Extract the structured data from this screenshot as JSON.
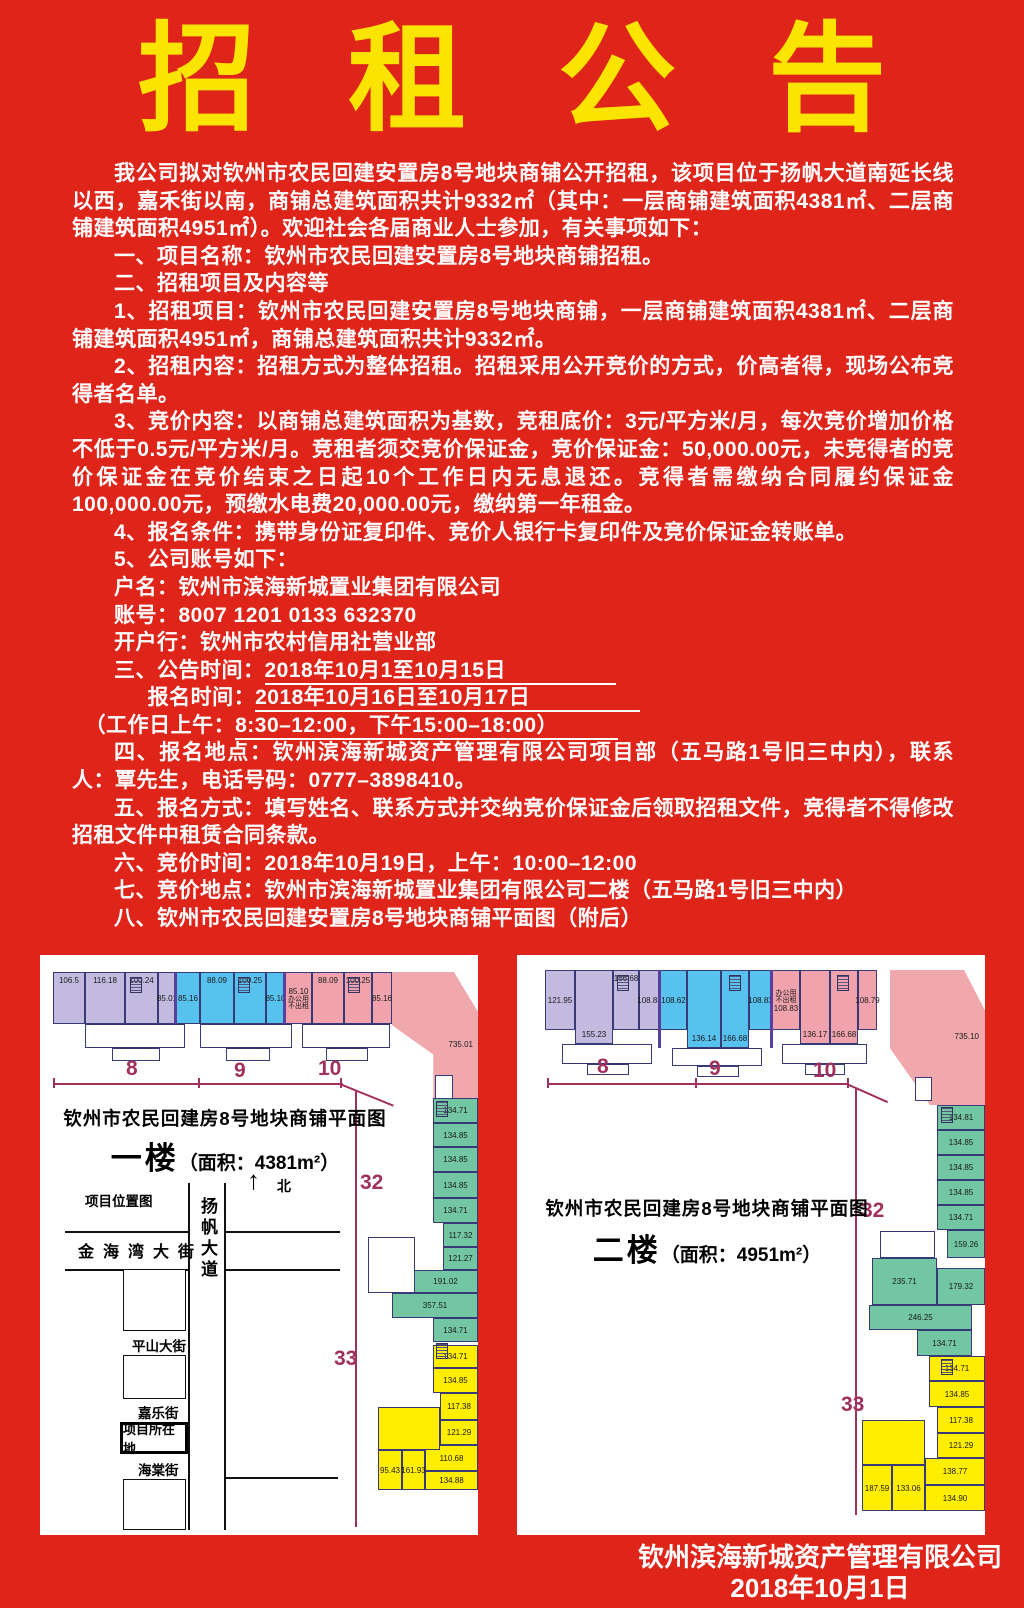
{
  "page": {
    "background": "#df241a",
    "title_color": "#fbe400",
    "text_color": "#ffffff"
  },
  "title": {
    "text": "招租公告",
    "chars": [
      "招",
      "租",
      "公",
      "告"
    ]
  },
  "body": {
    "p1": "我公司拟对钦州市农民回建安置房8号地块商铺公开招租，该项目位于扬帆大道南延长线以西，嘉禾街以南，商铺总建筑面积共计9332㎡（其中：一层商铺建筑面积4381㎡、二层商铺建筑面积4951㎡）。欢迎社会各届商业人士参加，有关事项如下：",
    "p2": "一、项目名称：钦州市农民回建安置房8号地块商铺招租。",
    "p3": "二、招租项目及内容等",
    "p4": "1、招租项目：钦州市农民回建安置房8号地块商铺，一层商铺建筑面积4381㎡、二层商铺建筑面积4951㎡，商铺总建筑面积共计9332㎡。",
    "p5": "2、招租内容：招租方式为整体招租。招租采用公开竞价的方式，价高者得，现场公布竞得者名单。",
    "p6": "3、竞价内容：以商铺总建筑面积为基数，竞租底价：3元/平方米/月，每次竞价增加价格不低于0.5元/平方米/月。竞租者须交竞价保证金，竞价保证金：50,000.00元，未竞得者的竞价保证金在竞价结束之日起10个工作日内无息退还。竞得者需缴纳合同履约保证金100,000.00元，预缴水电费20,000.00元，缴纳第一年租金。",
    "p7": "4、报名条件：携带身份证复印件、竞价人银行卡复印件及竞价保证金转账单。",
    "p8": "5、公司账号如下：",
    "p9": "户名：钦州市滨海新城置业集团有限公司",
    "p10": "账号：8007 1201 0133 632370",
    "p11": "开户行：钦州市农村信用社营业部",
    "p12_label": "三、公告时间：",
    "p12_value": "2018年10月1至10月15日",
    "p13_label": "报名时间：",
    "p13_value": "2018年10月16日至10月17日",
    "p14_label": "（工作日上午：",
    "p14_value": "8:30–12:00，下午15:00–18:00）",
    "p15": "四、报名地点：钦州滨海新城资产管理有限公司项目部（五马路1号旧三中内），联系人：覃先生，电话号码：0777–3898410。",
    "p16": "五、报名方式：填写姓名、联系方式并交纳竞价保证金后领取招租文件，竞得者不得修改招租文件中租赁合同条款。",
    "p17": "六、竞价时间：2018年10月19日，上午：10:00–12:00",
    "p18": "七、竞价地点：钦州市滨海新城置业集团有限公司二楼（五马路1号旧三中内）",
    "p19": "八、钦州市农民回建安置房8号地块商铺平面图（附后）"
  },
  "plans": [
    {
      "title": "钦州市农民回建房8号地块商铺平面图",
      "floor": "一楼",
      "area": "（面积：4381m²）",
      "note1": "办公用",
      "note2": "不出租",
      "purple": [
        "106.5",
        "116.18",
        "100.24",
        "85.01"
      ],
      "blue": [
        "85.16",
        "88.09",
        "100.25",
        "85.10"
      ],
      "pink": [
        "85.10",
        "88.09",
        "100.25",
        "85.16"
      ],
      "wedge": "735.01",
      "green": [
        "134.71",
        "134.85",
        "134.85",
        "134.85",
        "134.71",
        "117.32",
        "121.27",
        "191.02",
        "357.51",
        "134.71"
      ],
      "yellow": [
        "134.71",
        "134.85",
        "117.38",
        "121.29",
        "110.68",
        "134.88",
        "95.43",
        "161.93"
      ],
      "dims": {
        "d8": "8",
        "d9": "9",
        "d10": "10",
        "d32": "32",
        "d33": "33"
      },
      "map": {
        "label": "项目位置图",
        "north": "北",
        "north_arrow": "↑",
        "road": "扬帆大道",
        "street1": "金海湾大街",
        "street2": "平山大街",
        "street3": "嘉乐街",
        "site": "项目所在地",
        "street4": "海棠街"
      }
    },
    {
      "title": "钦州市农民回建房8号地块商铺平面图",
      "floor": "二楼",
      "area": "（面积：4951m²）",
      "note1": "办公用",
      "note2": "不出租",
      "purple": [
        "121.95",
        "155.23",
        "166.68",
        "108.83"
      ],
      "blue": [
        "108.62",
        "136.14",
        "166.68",
        "108.83"
      ],
      "pink": [
        "108.83",
        "136.17",
        "166.68",
        "108.79"
      ],
      "wedge": "735.10",
      "green": [
        "134.81",
        "134.85",
        "134.85",
        "134.85",
        "134.71",
        "159.26",
        "235.71",
        "179.32",
        "246.25",
        "134.71"
      ],
      "yellow": [
        "134.71",
        "134.85",
        "117.38",
        "121.29",
        "138.77",
        "134.90",
        "187.59",
        "133.06"
      ],
      "dims": {
        "d8": "8",
        "d9": "9",
        "d10": "10",
        "d32": "32",
        "d33": "33"
      }
    }
  ],
  "footer": {
    "line1": "钦州滨海新城资产管理有限公司",
    "line2": "2018年10月1日"
  }
}
